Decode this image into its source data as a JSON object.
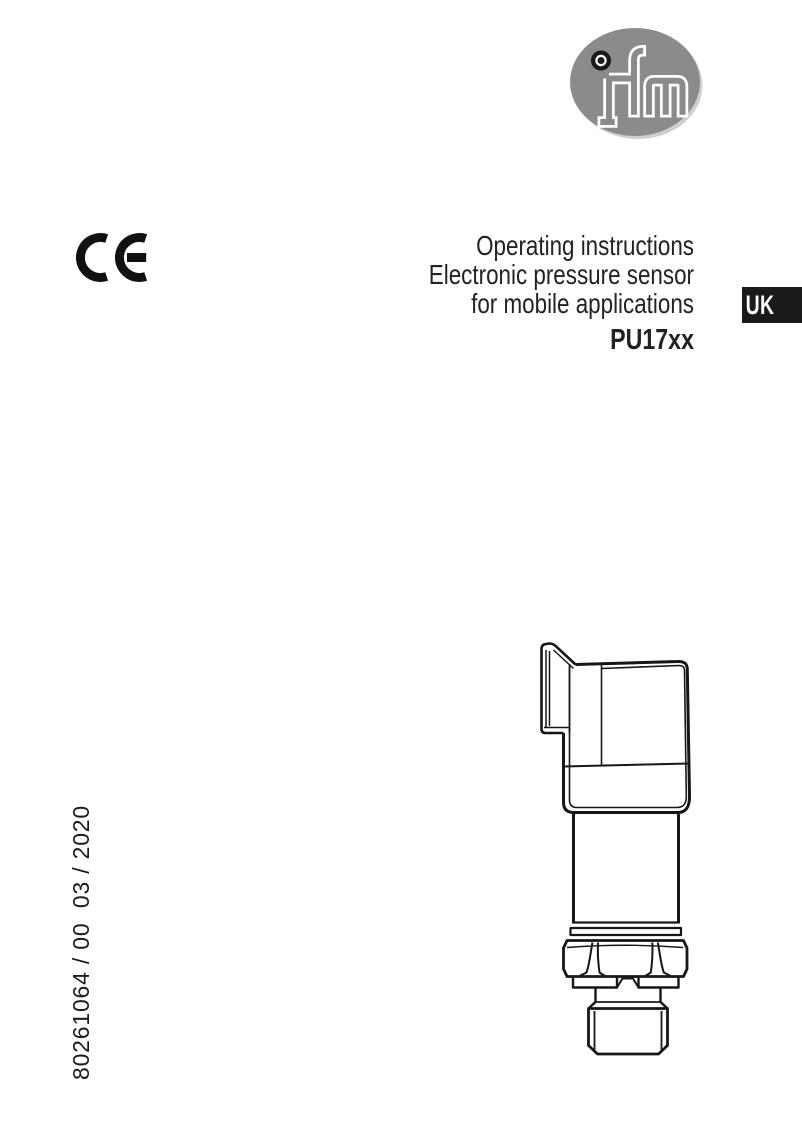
{
  "page": {
    "width": 802,
    "height": 1130,
    "background": "#ffffff"
  },
  "brand_logo": {
    "name": "ifm",
    "ellipse_color": "#8b8b8b",
    "shadow_color": "#cfcfcf",
    "letter_outline_color": "#ffffff",
    "dot_color": "#1a1a1a"
  },
  "certification": {
    "mark": "CE",
    "color": "#111111"
  },
  "title_block": {
    "lines": [
      "Operating instructions",
      "Electronic pressure sensor",
      "for mobile applications"
    ],
    "model": "PU17xx"
  },
  "language_badge": {
    "label": "UK",
    "background": "#1a1a1a",
    "color": "#ffffff"
  },
  "document_number": {
    "text": "80261064 / 00  03 / 2020"
  },
  "illustration": {
    "description": "pressure sensor technical line drawing",
    "line_color": "#161616"
  }
}
